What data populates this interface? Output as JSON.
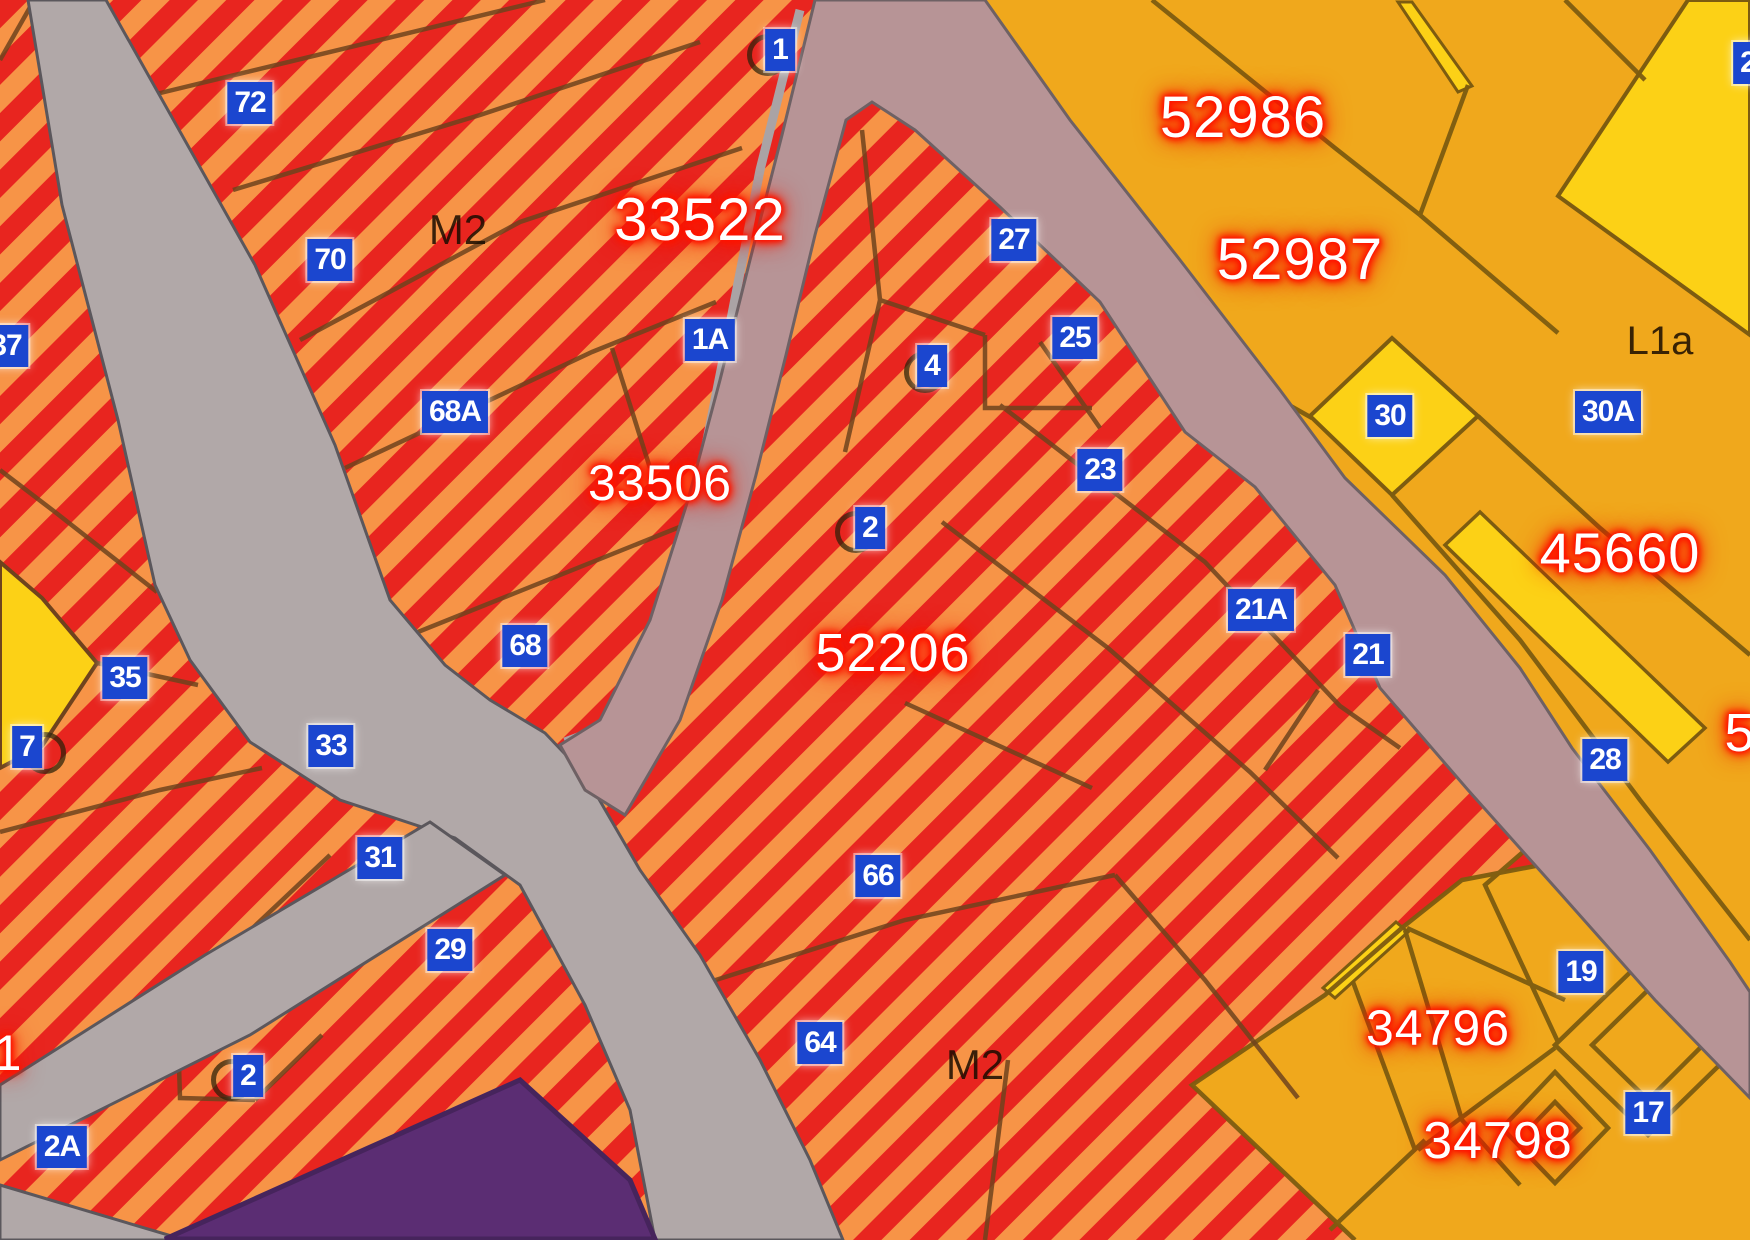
{
  "canvas": {
    "width": 1750,
    "height": 1240
  },
  "colors": {
    "stripe_red": "#e8251f",
    "stripe_orange": "#f79447",
    "orange_parcel": "#f0a81c",
    "yellow_parcel": "#fcd116",
    "road_gray": "#b1a8a8",
    "road_pink": "#b79496",
    "purple_parcel": "#5b2d73",
    "badge_blue": "#1b46cf",
    "boundary_brown": "#6f431d",
    "boundary_olive": "#7d5c10",
    "glow_red": "#ff1500"
  },
  "parcel_labels": [
    {
      "text": "33522",
      "x": 700,
      "y": 220,
      "size": 60
    },
    {
      "text": "33506",
      "x": 660,
      "y": 483,
      "size": 50
    },
    {
      "text": "52206",
      "x": 893,
      "y": 653,
      "size": 54
    },
    {
      "text": "52986",
      "x": 1243,
      "y": 118,
      "size": 58
    },
    {
      "text": "52987",
      "x": 1300,
      "y": 260,
      "size": 58
    },
    {
      "text": "45660",
      "x": 1620,
      "y": 553,
      "size": 56
    },
    {
      "text": "34796",
      "x": 1438,
      "y": 1028,
      "size": 50
    },
    {
      "text": "34798",
      "x": 1498,
      "y": 1141,
      "size": 52
    },
    {
      "text": "1",
      "x": 8,
      "y": 1053,
      "size": 50
    },
    {
      "text": "5",
      "x": 1740,
      "y": 733,
      "size": 54
    }
  ],
  "zone_labels": [
    {
      "text": "M2",
      "x": 458,
      "y": 230,
      "size": 42
    },
    {
      "text": "M2",
      "x": 975,
      "y": 1065,
      "size": 42
    },
    {
      "text": "L1a",
      "x": 1660,
      "y": 341,
      "size": 40
    }
  ],
  "address_badges": [
    {
      "label": "72",
      "x": 250,
      "y": 103
    },
    {
      "label": "70",
      "x": 330,
      "y": 260
    },
    {
      "label": "68A",
      "x": 455,
      "y": 412
    },
    {
      "label": "1A",
      "x": 710,
      "y": 340
    },
    {
      "label": "1",
      "x": 780,
      "y": 50
    },
    {
      "label": "68",
      "x": 525,
      "y": 646
    },
    {
      "label": "37",
      "x": 6,
      "y": 346
    },
    {
      "label": "35",
      "x": 125,
      "y": 678
    },
    {
      "label": "7",
      "x": 27,
      "y": 747
    },
    {
      "label": "33",
      "x": 331,
      "y": 746
    },
    {
      "label": "31",
      "x": 380,
      "y": 858
    },
    {
      "label": "29",
      "x": 450,
      "y": 950
    },
    {
      "label": "2",
      "x": 248,
      "y": 1076
    },
    {
      "label": "2A",
      "x": 62,
      "y": 1147
    },
    {
      "label": "27",
      "x": 1014,
      "y": 240
    },
    {
      "label": "4",
      "x": 932,
      "y": 366
    },
    {
      "label": "25",
      "x": 1075,
      "y": 338
    },
    {
      "label": "23",
      "x": 1100,
      "y": 470
    },
    {
      "label": "2",
      "x": 870,
      "y": 528
    },
    {
      "label": "21A",
      "x": 1261,
      "y": 610
    },
    {
      "label": "21",
      "x": 1368,
      "y": 655
    },
    {
      "label": "30",
      "x": 1390,
      "y": 416
    },
    {
      "label": "30A",
      "x": 1608,
      "y": 412
    },
    {
      "label": "28",
      "x": 1605,
      "y": 760
    },
    {
      "label": "19",
      "x": 1581,
      "y": 972
    },
    {
      "label": "17",
      "x": 1648,
      "y": 1113
    },
    {
      "label": "66",
      "x": 878,
      "y": 876
    },
    {
      "label": "64",
      "x": 820,
      "y": 1043
    },
    {
      "label": "2",
      "x": 1748,
      "y": 63
    }
  ],
  "point_markers": [
    {
      "x": 768,
      "y": 55
    },
    {
      "x": 925,
      "y": 372
    },
    {
      "x": 856,
      "y": 532
    },
    {
      "x": 45,
      "y": 753
    },
    {
      "x": 232,
      "y": 1080
    }
  ]
}
